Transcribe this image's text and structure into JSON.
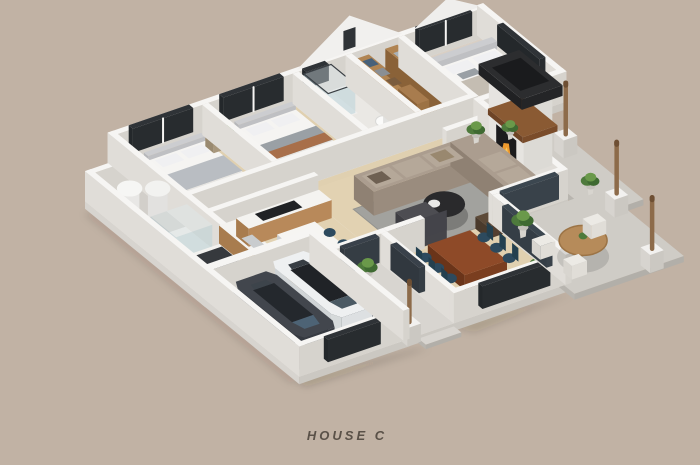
{
  "caption": {
    "text": "HOUSE C"
  },
  "palette": {
    "bg": "#c1b2a4",
    "text": "#5a5148",
    "wall": "#f6f5f3",
    "wall_w": "#e0ddd8",
    "wall_s": "#d6d3cd",
    "slab": "#f2f1ef",
    "slab_w": "#d7d4cf",
    "slab_s": "#cbc8c2",
    "wood_floor": "#e0d0b0",
    "wood_floor2": "#d8c49e",
    "tile": "#eae8e4",
    "concrete": "#cfccc6",
    "concrete_w": "#b8b5af",
    "concrete_s": "#b2afa9",
    "walkway": "#d8d5d0",
    "garage_floor": "#4a515a",
    "window_dark": "#2f3337",
    "glass_door": "#39414a",
    "glass_slider": "#3c4750",
    "sofa": "#ab9d8f",
    "sofa_w": "#8f8173",
    "sofa_s": "#9a8c7e",
    "cushion": "#b5a899",
    "rug": "#a2a29e",
    "coffee_table": "#2a2a2c",
    "armchair": "#4d4d52",
    "ottoman": "#5d4a38",
    "dining_table": "#8e4a28",
    "dining_table_w": "#6a3419",
    "dining_table_s": "#7a3e1f",
    "chair_navy": "#2d4a5e",
    "closet_wood": "#b08452",
    "closet_wood_w": "#8a6238",
    "closet_wood_s": "#9c7244",
    "counter_wood": "#a87c4e",
    "fire_cap": "#2c2d2f",
    "mantel": "#8a5a33",
    "firebox": "#1b1b1d",
    "flame": "#ef9a2e",
    "flame2": "#f8c95c",
    "plant_dark": "#3f6a32",
    "plant_mid": "#4e7a3c",
    "plant_light": "#6a994a",
    "post_wood": "#8d6b4a",
    "car_white": "#eef0f1",
    "car_white_w": "#d0d4d6",
    "car_white_s": "#dde0e2",
    "car_dark": "#42464d",
    "car_dark_w": "#31353b",
    "car_dark_s": "#383c43",
    "car_roof": "#202327",
    "car_roof_dark": "#24282d",
    "windshield": "#4b5a64",
    "windshield_dark": "#4d6375",
    "wheel": "#1a1c1e",
    "bed_white": "#f5f4f2",
    "headboard": "#cccdd0",
    "blanket_gray": "#b9bdc2",
    "blanket_rust": "#a86f4a",
    "blanket_master": "#c4bdb2",
    "glass_shower": "rgba(190,214,220,0.45)"
  }
}
